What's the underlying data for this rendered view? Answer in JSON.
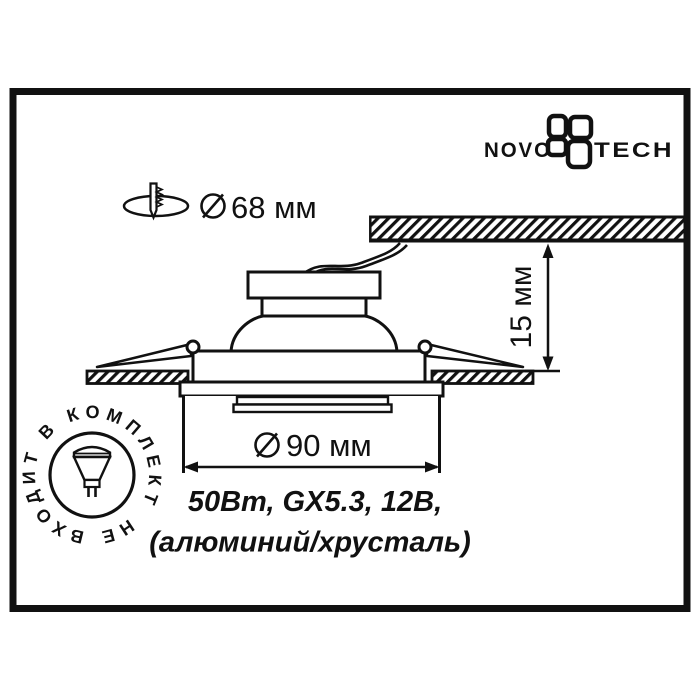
{
  "brand": {
    "wordmark_left": "NOVO",
    "wordmark_right": "TECH"
  },
  "cutout_dimension": {
    "value": "68 мм",
    "symbol": "diameter"
  },
  "recess_dimension": {
    "value": "15 мм"
  },
  "diameter_dimension": {
    "value": "90 мм",
    "symbol": "diameter"
  },
  "specs": {
    "line1": "50Вт, GX5.3, 12В,",
    "line2": "(алюминий/хрусталь)"
  },
  "stamp": {
    "circular_text": "НЕ ВХОДИТ В КОМПЛЕКТ"
  },
  "colors": {
    "ink": "#111111",
    "paper": "#ffffff"
  }
}
